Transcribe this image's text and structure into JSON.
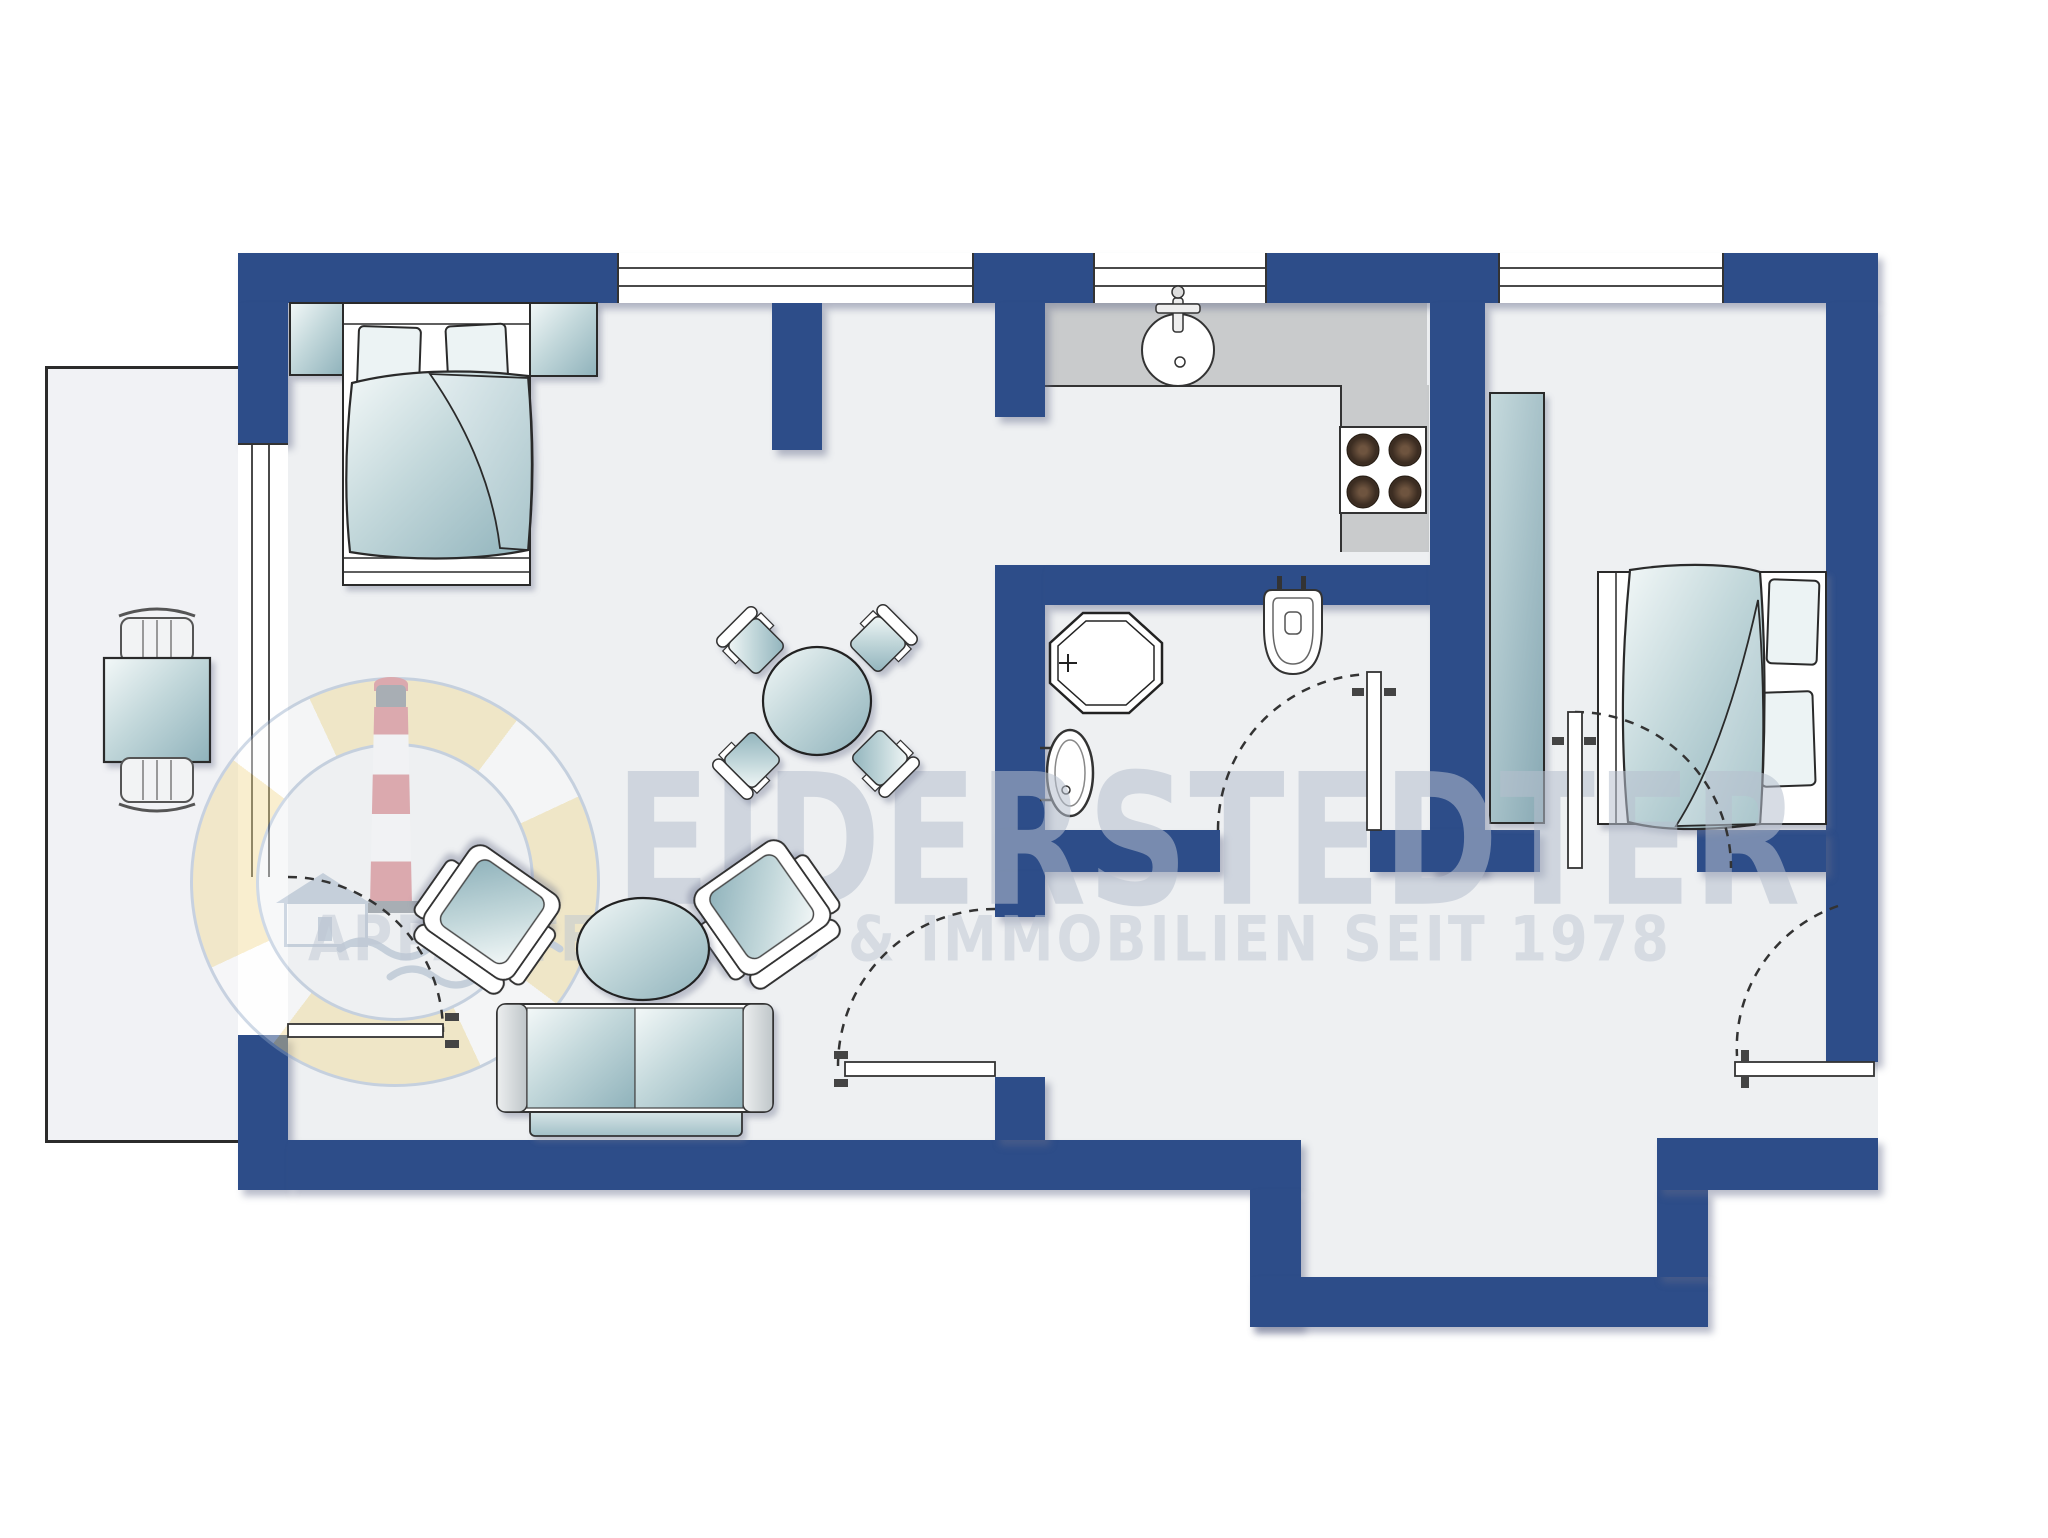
{
  "watermark": {
    "line1": "EIDERSTEDTER",
    "line2": "APPARTEMENTS & IMMOBILIEN SEIT 1978"
  },
  "colors": {
    "wall": "#2d4d89",
    "floor": "#eef0f2",
    "terrace_floor": "#f1f2f5",
    "counter": "#c9cbcc",
    "furniture_teal": "#9dbcc4",
    "furniture_light": "#f3f8f8",
    "outline": "#2b2b2b",
    "watermark_text": "#b7c0cd",
    "logo_yellow": "#f2d98e",
    "logo_red": "#c24a52",
    "logo_blue_gray": "#8fa6c4"
  }
}
